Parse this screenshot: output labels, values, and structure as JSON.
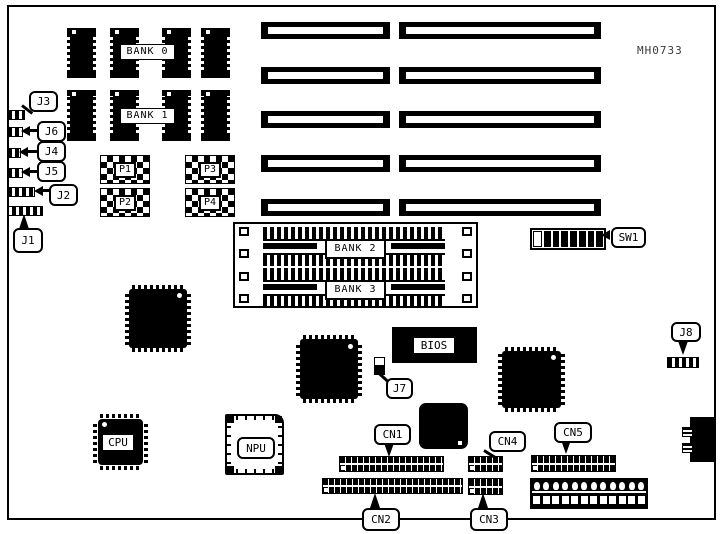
{
  "board": {
    "part_number": "MH0733",
    "banks": {
      "bank0": "BANK 0",
      "bank1": "BANK 1",
      "bank2": "BANK 2",
      "bank3": "BANK 3"
    },
    "chips": {
      "cpu": "CPU",
      "npu": "NPU",
      "bios": "BIOS"
    },
    "sockets": {
      "p1": "P1",
      "p2": "P2",
      "p3": "P3",
      "p4": "P4"
    },
    "jumpers": {
      "j1": "J1",
      "j2": "J2",
      "j3": "J3",
      "j4": "J4",
      "j5": "J5",
      "j6": "J6",
      "j7": "J7",
      "j8": "J8"
    },
    "connectors": {
      "cn1": "CN1",
      "cn2": "CN2",
      "cn3": "CN3",
      "cn4": "CN4",
      "cn5": "CN5"
    },
    "switches": {
      "sw1": "SW1"
    }
  }
}
